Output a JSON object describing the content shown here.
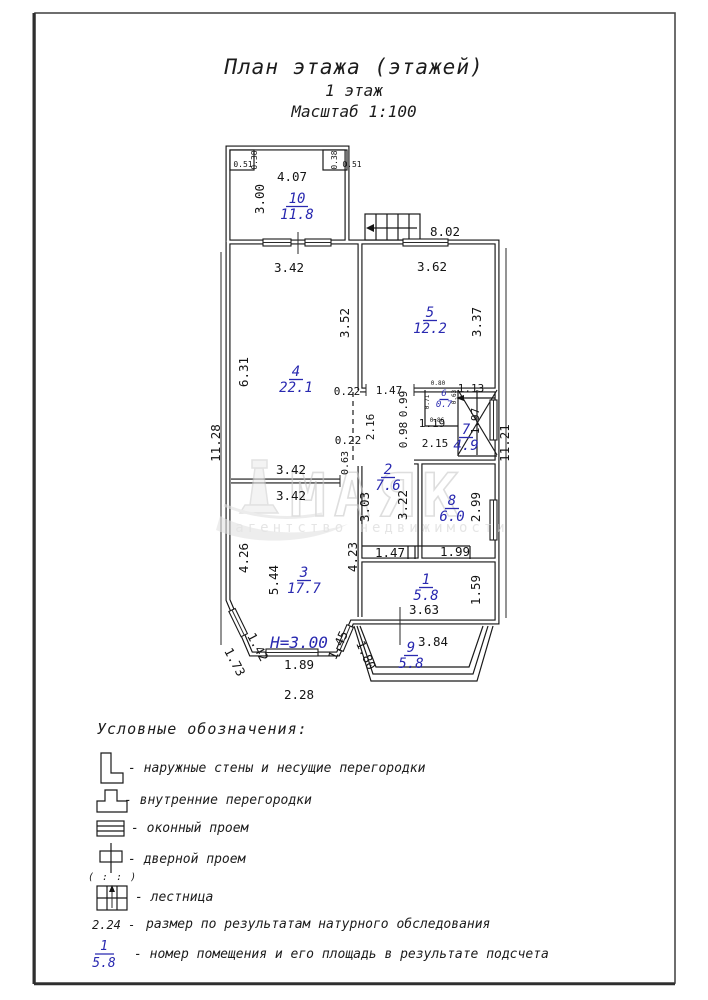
{
  "page": {
    "title": "План этажа (этажей)",
    "subtitle": "1 этаж",
    "scale": "Масштаб 1:100"
  },
  "watermark": {
    "name": "МАЯК",
    "tagline": "агентство недвижимости"
  },
  "plan": {
    "height_label": "H=3.00",
    "rooms": [
      {
        "n": "10",
        "a": "11.8",
        "x": 297,
        "y": 203,
        "s": 14,
        "w": 22
      },
      {
        "n": "5",
        "a": "12.2",
        "x": 430,
        "y": 317,
        "s": 14,
        "w": 14
      },
      {
        "n": "4",
        "a": "22.1",
        "x": 296,
        "y": 376,
        "s": 14,
        "w": 14
      },
      {
        "n": "6",
        "a": "0.7",
        "x": 444,
        "y": 396,
        "s": 9,
        "w": 9
      },
      {
        "n": "7",
        "a": "4.9",
        "x": 466,
        "y": 434,
        "s": 14,
        "w": 14
      },
      {
        "n": "2",
        "a": "7.6",
        "x": 388,
        "y": 474,
        "s": 14,
        "w": 14
      },
      {
        "n": "8",
        "a": "6.0",
        "x": 452,
        "y": 505,
        "s": 14,
        "w": 14
      },
      {
        "n": "3",
        "a": "17.7",
        "x": 304,
        "y": 577,
        "s": 14,
        "w": 14
      },
      {
        "n": "1",
        "a": "5.8",
        "x": 426,
        "y": 584,
        "s": 14,
        "w": 14
      },
      {
        "n": "9",
        "a": "5.8",
        "x": 411,
        "y": 652,
        "s": 14,
        "w": 14
      }
    ],
    "dims": [
      {
        "t": "0.51",
        "x": 243,
        "y": 167,
        "s": 8
      },
      {
        "t": "0.38",
        "x": 257,
        "y": 160,
        "s": 8,
        "r": -90
      },
      {
        "t": "0.38",
        "x": 337,
        "y": 160,
        "s": 8,
        "r": -90
      },
      {
        "t": "0.51",
        "x": 352,
        "y": 167,
        "s": 8
      },
      {
        "t": "4.07",
        "x": 292,
        "y": 181
      },
      {
        "t": "3.00",
        "x": 264,
        "y": 199,
        "r": -90
      },
      {
        "t": "8.02",
        "x": 445,
        "y": 236
      },
      {
        "t": "3.42",
        "x": 289,
        "y": 272
      },
      {
        "t": "3.62",
        "x": 432,
        "y": 271
      },
      {
        "t": "3.52",
        "x": 349,
        "y": 323,
        "r": -90
      },
      {
        "t": "3.37",
        "x": 481,
        "y": 322,
        "r": -90
      },
      {
        "t": "6.31",
        "x": 248,
        "y": 372,
        "r": -90
      },
      {
        "t": "11.28",
        "x": 220,
        "y": 443,
        "r": -90
      },
      {
        "t": "0.22",
        "x": 347,
        "y": 395,
        "s": 11
      },
      {
        "t": "1.47",
        "x": 389,
        "y": 394,
        "s": 11
      },
      {
        "t": "0.99",
        "x": 407,
        "y": 404,
        "s": 11,
        "r": -90
      },
      {
        "t": "1.13",
        "x": 471,
        "y": 392,
        "s": 11
      },
      {
        "t": "2.16",
        "x": 374,
        "y": 427,
        "s": 11,
        "r": -90
      },
      {
        "t": "0.98",
        "x": 407,
        "y": 435,
        "s": 11,
        "r": -90
      },
      {
        "t": "1.19",
        "x": 432,
        "y": 427,
        "s": 11
      },
      {
        "t": "2.15",
        "x": 435,
        "y": 447,
        "s": 11
      },
      {
        "t": "1.97",
        "x": 479,
        "y": 421,
        "s": 11,
        "r": -90
      },
      {
        "t": "11.21",
        "x": 509,
        "y": 443,
        "r": -90
      },
      {
        "t": "0.80",
        "x": 438,
        "y": 385,
        "s": 6
      },
      {
        "t": "0.71",
        "x": 429,
        "y": 402,
        "s": 6,
        "r": -90
      },
      {
        "t": "0.63",
        "x": 456,
        "y": 397,
        "s": 6,
        "r": -90
      },
      {
        "t": "0.86",
        "x": 437,
        "y": 422,
        "s": 6
      },
      {
        "t": "0.22",
        "x": 348,
        "y": 444,
        "s": 11
      },
      {
        "t": "0.63",
        "x": 348,
        "y": 463,
        "s": 10,
        "r": -90
      },
      {
        "t": "3.42",
        "x": 291,
        "y": 474
      },
      {
        "t": "3.42",
        "x": 291,
        "y": 500
      },
      {
        "t": "3.03",
        "x": 369,
        "y": 507,
        "r": -90
      },
      {
        "t": "3.22",
        "x": 407,
        "y": 505,
        "r": -90
      },
      {
        "t": "2.99",
        "x": 480,
        "y": 507,
        "r": -90
      },
      {
        "t": "4.26",
        "x": 248,
        "y": 558,
        "r": -90
      },
      {
        "t": "5.44",
        "x": 278,
        "y": 580,
        "r": -90
      },
      {
        "t": "4.23",
        "x": 357,
        "y": 557,
        "r": -90
      },
      {
        "t": "1.47",
        "x": 390,
        "y": 557
      },
      {
        "t": "1.99",
        "x": 455,
        "y": 556
      },
      {
        "t": "1.59",
        "x": 480,
        "y": 590,
        "r": -90
      },
      {
        "t": "3.63",
        "x": 424,
        "y": 614
      },
      {
        "t": "1.42",
        "x": 254,
        "y": 649,
        "r": 62
      },
      {
        "t": "1.73",
        "x": 231,
        "y": 664,
        "r": 62
      },
      {
        "t": "1.45",
        "x": 342,
        "y": 647,
        "r": -65
      },
      {
        "t": "1.80",
        "x": 362,
        "y": 657,
        "r": 66
      },
      {
        "t": "1.89",
        "x": 299,
        "y": 669
      },
      {
        "t": "3.84",
        "x": 433,
        "y": 646
      },
      {
        "t": "2.28",
        "x": 299,
        "y": 699
      }
    ]
  },
  "legend": {
    "heading": "Условные обозначения:",
    "items": [
      {
        "symbol": "outer-wall",
        "label": "- наружные стены и несущие перегородки"
      },
      {
        "symbol": "inner-wall",
        "label": "- внутренние перегородки"
      },
      {
        "symbol": "window",
        "label": "- оконный проем"
      },
      {
        "symbol": "door",
        "label": "- дверной проем"
      },
      {
        "symbol": "stairs",
        "label": "- лестница"
      }
    ],
    "door_dashes": "( : : )",
    "size_key": "2.24 -",
    "size_label": "размер по результатам натурного обследования",
    "fraction": {
      "num": "1",
      "den": "5.8"
    },
    "fraction_label": "- номер помещения и его площадь в результате подсчета"
  },
  "colors": {
    "accent_blue": "#2929b0",
    "line": "#141414",
    "watermark_gray": "#cfcfcf"
  }
}
